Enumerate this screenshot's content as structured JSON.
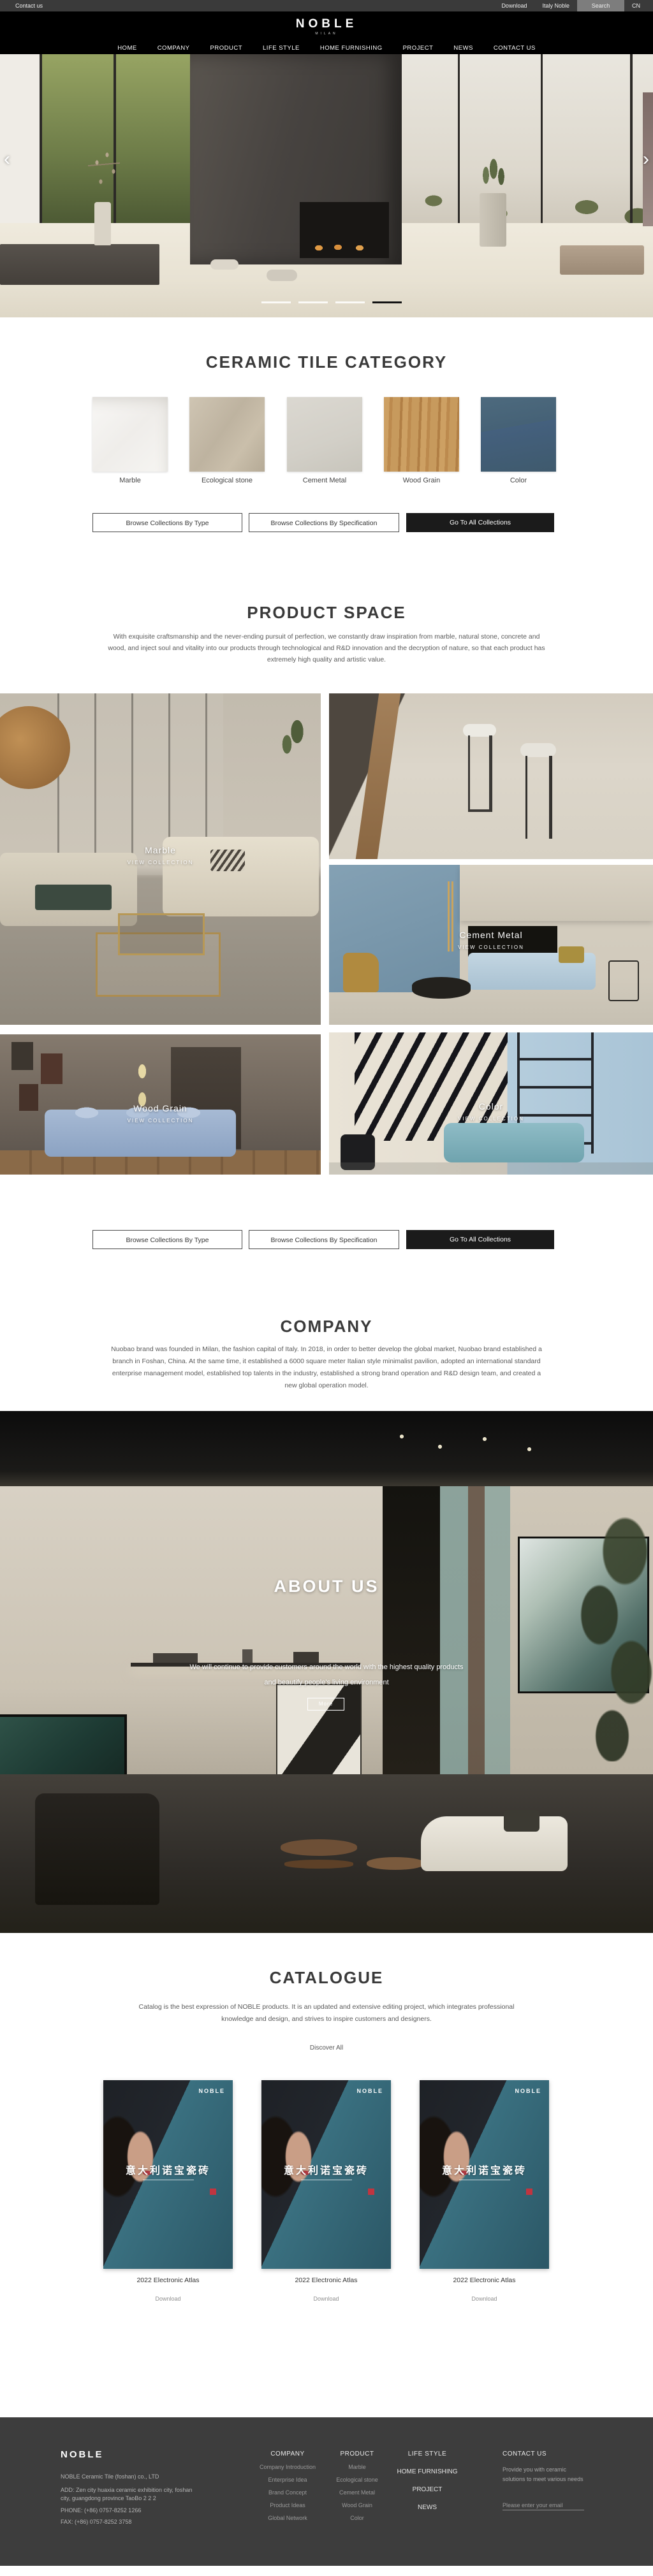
{
  "topbar": {
    "contact": "Contact us",
    "download": "Download",
    "italy": "Italy Noble",
    "search": "Search",
    "lang": "CN"
  },
  "header": {
    "logo": "NOBLE",
    "logo_sub": "MILAN",
    "nav": [
      "HOME",
      "COMPANY",
      "PRODUCT",
      "LIFE STYLE",
      "HOME FURNISHING",
      "PROJECT",
      "NEWS",
      "CONTACT US"
    ]
  },
  "hero": {
    "prev_icon": "‹",
    "next_icon": "›"
  },
  "collection_buttons": [
    "Browse Collections By Type",
    "Browse Collections By Specification",
    "Go To All Collections"
  ],
  "category": {
    "title": "CERAMIC TILE CATEGORY",
    "tiles": [
      {
        "label": "Marble"
      },
      {
        "label": "Ecological stone"
      },
      {
        "label": "Cement Metal"
      },
      {
        "label": "Wood Grain"
      },
      {
        "label": "Color"
      }
    ]
  },
  "product_space": {
    "title": "PRODUCT SPACE",
    "description": "With exquisite craftsmanship and the never-ending pursuit of perfection, we constantly draw inspiration from marble, natural stone, concrete and wood, and inject soul and vitality into our products through technological and R&D innovation and the decryption of nature, so that each product has extremely high quality and artistic value.",
    "cells": [
      {
        "label": "Marble",
        "sub": "VIEW COLLECTION"
      },
      {
        "label": "Cement Metal",
        "sub": "VIEW COLLECTION"
      },
      {
        "label": "Wood Grain",
        "sub": "VIEW COLLECTION"
      },
      {
        "label": "Color",
        "sub": "VIEW COLLECTION"
      }
    ]
  },
  "company": {
    "title": "COMPANY",
    "description": "Nuobao brand was founded in Milan, the fashion capital of Italy. In 2018, in order to better develop the global market, Nuobao brand established a branch in Foshan, China. At the same time, it established a 6000 square meter Italian style minimalist pavilion, adopted an international standard enterprise management model, established top talents in the industry, established a strong brand operation and R&D design team, and created a new global operation model."
  },
  "about": {
    "title": "ABOUT US",
    "line1": "We will continue to provide customers around the world with the highest quality products",
    "line2": "and beautify people's living environment",
    "more": "More"
  },
  "catalogue": {
    "title": "CATALOGUE",
    "description": "Catalog is the best expression of NOBLE products. It is an updated and extensive editing project, which integrates professional knowledge and design, and strives to inspire customers and designers.",
    "discover": "Discover All",
    "cards": [
      {
        "brand": "NOBLE",
        "title_cn": "意大利诺宝瓷砖",
        "name": "2022 Electronic Atlas",
        "download": "Download"
      },
      {
        "brand": "NOBLE",
        "title_cn": "意大利诺宝瓷砖",
        "name": "2022 Electronic Atlas",
        "download": "Download"
      },
      {
        "brand": "NOBLE",
        "title_cn": "意大利诺宝瓷砖",
        "name": "2022 Electronic Atlas",
        "download": "Download"
      }
    ]
  },
  "footer": {
    "brand": "NOBLE",
    "company_name": "NOBLE Ceramic Tile (foshan) co., LTD",
    "address_line1": "ADD:  Zen city huaxia ceramic exhibition city, foshan",
    "address_line2": "city, guangdong province TaoBo 2 2 2",
    "phone": "PHONE:   (+86)  0757-8252 1266",
    "fax": "FAX:   (+86)  0757-8252 3758",
    "col_company": {
      "title": "COMPANY",
      "items": [
        "Company Introduction",
        "Enterprise Idea",
        "Brand Concept",
        "Product Ideas",
        "Global Network"
      ]
    },
    "col_product": {
      "title": "PRODUCT",
      "items": [
        "Marble",
        "Ecological stone",
        "Cement Metal",
        "Wood Grain",
        "Color"
      ]
    },
    "col_nav": {
      "title": "LIFE STYLE",
      "items": [
        "HOME FURNISHING",
        "PROJECT",
        "NEWS"
      ]
    },
    "col_contact": {
      "title": "CONTACT US",
      "text": "Provide you with ceramic solutions to meet various needs",
      "email_placeholder": "Please enter your email"
    }
  },
  "colors": {
    "accent_dark": "#1b1b1b",
    "footer_bg": "#3d3d3d",
    "catalog_teal": "#33707f",
    "topbar_bg": "#3a3a3a"
  }
}
